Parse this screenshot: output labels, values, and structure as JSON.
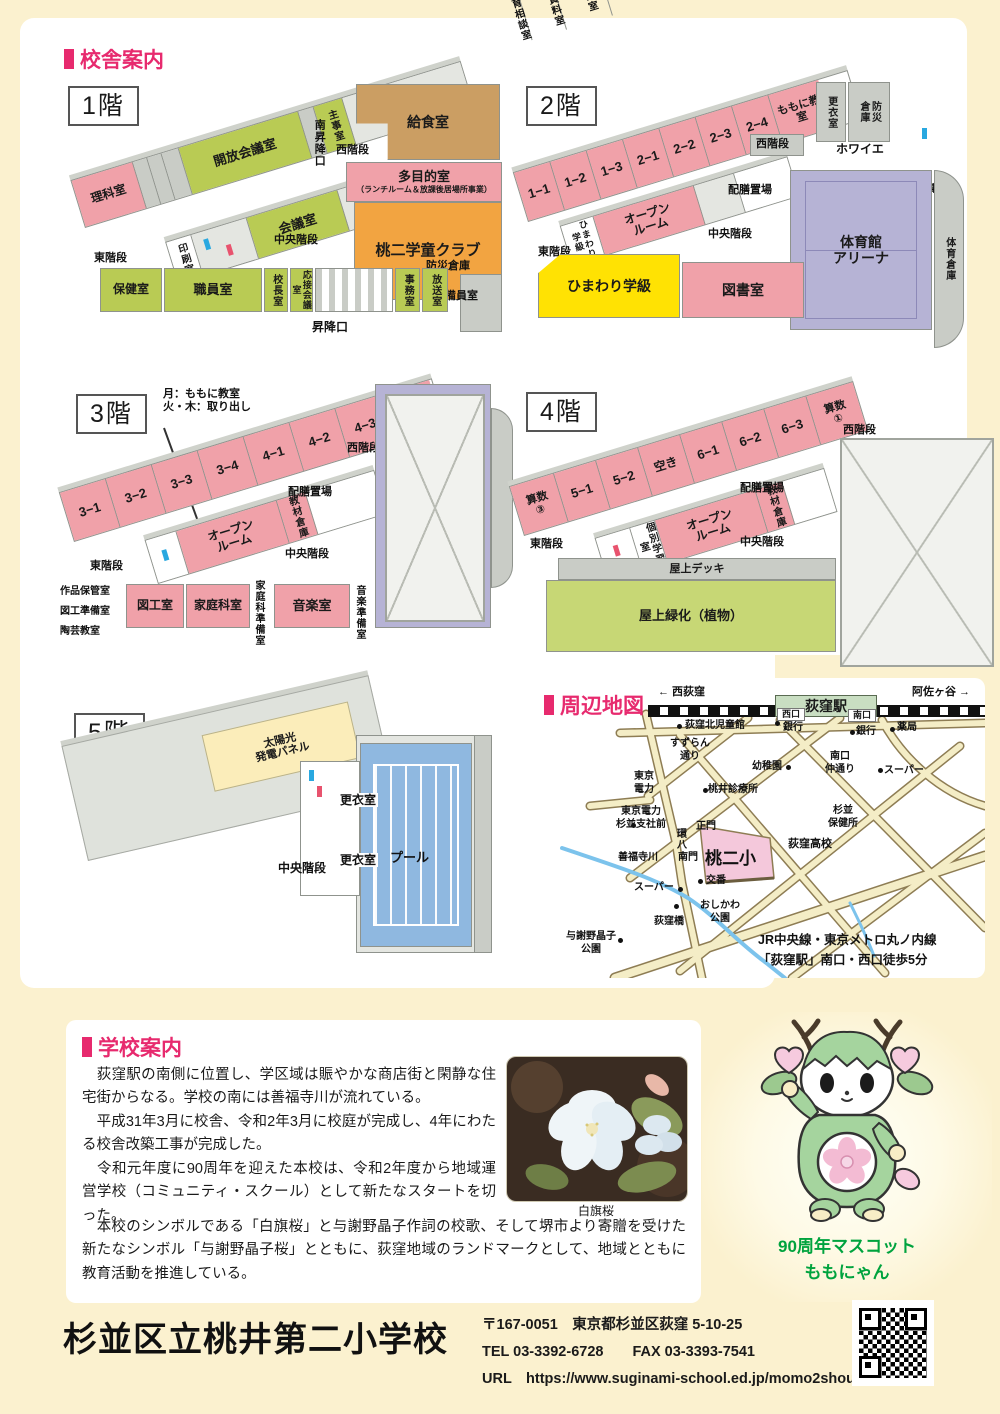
{
  "headers": {
    "building": "校舎案内",
    "map": "周辺地図",
    "school": "学校案内"
  },
  "floors": {
    "f1": {
      "tag": "1階",
      "rooms": {
        "rika": "理科室",
        "sodan": "教育相談室",
        "kyodo": "郷土資料室",
        "toyukai": "桃友会\n学校支援本部室",
        "kaiho": "開放会議室",
        "shuji": "主事室",
        "minami_shoko": "南昇降口",
        "nishi": "西階段",
        "kyushoku": "給食室",
        "tamokuteki": "多目的室",
        "tamokuteki_sub": "（ランチルーム＆放課後居場所事業）",
        "insatsu": "印刷室",
        "kaigi": "会議室",
        "gakudo": "桃二学童クラブ",
        "chuo": "中央階段",
        "higashi": "東階段",
        "hoken": "保健室",
        "shokuin": "職員室",
        "kocho": "校長室",
        "osetsu": "応接会議室",
        "jimu": "事務室",
        "hoso": "放送室",
        "bosai": "防災倉庫",
        "keibi": "警備員室",
        "shoko": "昇降口"
      }
    },
    "f2": {
      "tag": "2階",
      "rooms": {
        "c11": "1−1",
        "c12": "1−2",
        "c13": "1−3",
        "c21": "2−1",
        "c22": "2−2",
        "c23": "2−3",
        "c24": "2−4",
        "momoni": "ももに教室",
        "koui": "更衣室",
        "bosai": "防災\n倉庫",
        "nishi": "西階段",
        "howaie": "ホワイエ",
        "kitaku": "帰宅困難倉庫",
        "gym": "体育館\nアリーナ",
        "taiiku_soko": "体育倉庫",
        "himawari_v": "ひまわり学級",
        "open": "オープン\nルーム",
        "haizen": "配膳置場",
        "chuo": "中央階段",
        "higashi": "東階段",
        "himawari": "ひまわり学級",
        "tosho": "図書室"
      }
    },
    "f3": {
      "tag": "3階",
      "note": "月：ももに教室\n火・木：取り出し",
      "rooms": {
        "c31": "3−1",
        "c32": "3−2",
        "c33": "3−3",
        "c34": "3−4",
        "c41": "4−1",
        "c42": "4−2",
        "c43": "4−3",
        "sansu2": "算数\n②",
        "nishi": "西階段",
        "open": "オープン\nルーム",
        "kyozai": "教材倉庫",
        "haizen": "配膳置場",
        "chuo": "中央階段",
        "higashi": "東階段",
        "sakuhin": "作品保管室",
        "zuko_junbi": "図工準備室",
        "togei": "陶芸教室",
        "zuko": "図工室",
        "katei": "家庭科室",
        "katei_junbi": "家庭科準備室",
        "ongaku": "音楽室",
        "ongaku_junbi": "音楽準備室"
      }
    },
    "f4": {
      "tag": "4階",
      "rooms": {
        "sansu3": "算数\n③",
        "c51": "5−1",
        "c52": "5−2",
        "aki": "空き",
        "c61": "6−1",
        "c62": "6−2",
        "c63": "6−3",
        "sansu1": "算数\n①",
        "nishi": "西階段",
        "kobetsu": "個別学習室",
        "open": "オープン\nルーム",
        "kyozai": "教材倉庫",
        "haizen": "配膳置場",
        "chuo": "中央階段",
        "higashi": "東階段",
        "deck": "屋上デッキ",
        "ryokka": "屋上緑化（植物）"
      }
    },
    "f5": {
      "tag": "5階",
      "rooms": {
        "solar": "太陽光\n発電パネル",
        "nishi": "西階段",
        "koui1": "更衣室",
        "koui2": "更衣室",
        "chuo": "中央階段",
        "pool": "プール"
      }
    }
  },
  "map": {
    "rail_left": "← 西荻窪",
    "rail_right": "阿佐ヶ谷 →",
    "station": "荻窪駅",
    "west_exit": "西口",
    "south_exit": "南口",
    "pois": {
      "jidokan": "荻窪北児童館",
      "bank1": "銀行",
      "bank2": "銀行",
      "yakkyoku": "薬局",
      "suzuran": "すずらん\n通り",
      "yochien": "幼稚園",
      "minamiguchi": "南口\n仲通り",
      "super1": "スーパー",
      "denryoku": "東京\n電力",
      "shinryojo": "桃井診療所",
      "shisha_mae": "東京電力\n杉並支社前",
      "kanpachi": "環八",
      "seimon": "正門",
      "hokenjo": "杉並\n保健所",
      "zenpukuji": "善福寺川",
      "nanmon": "南門",
      "school": "桃二小",
      "koko": "荻窪高校",
      "koban": "交番",
      "super2": "スーパー",
      "oshikawa": "おしかわ\n公園",
      "ogikubobashi": "荻窪橋",
      "yosano": "与謝野晶子\n公園"
    },
    "access": "JR中央線・東京メトロ丸ノ内線\n「荻窪駅」南口・西口徒歩5分"
  },
  "info": {
    "p1": "　荻窪駅の南側に位置し、学区域は賑やかな商店街と閑静な住宅街からなる。学校の南には善福寺川が流れている。",
    "p2": "　平成31年3月に校舎、令和2年3月に校庭が完成し、4年にわたる校舎改築工事が完成した。",
    "p3": "　令和元年度に90周年を迎えた本校は、令和2年度から地域運営学校（コミュニティ・スクール）として新たなスタートを切った。",
    "p4": "　本校のシンボルである「白旗桜」と与謝野晶子作詞の校歌、そして堺市より寄贈を受けた新たなシンボル「与謝野晶子桜」とともに、荻窪地域のランドマークとして、地域とともに教育活動を推進している。",
    "photo_caption": "白旗桜"
  },
  "mascot": {
    "caption": "90周年マスコット\nももにゃん"
  },
  "footer": {
    "name": "杉並区立桃井第二小学校",
    "address": "〒167-0051　東京都杉並区荻窪 5-10-25",
    "tel": "TEL 03-3392-6728　　FAX 03-3393-7541",
    "url": "URL　https://www.suginami-school.ed.jp/momo2shou"
  }
}
